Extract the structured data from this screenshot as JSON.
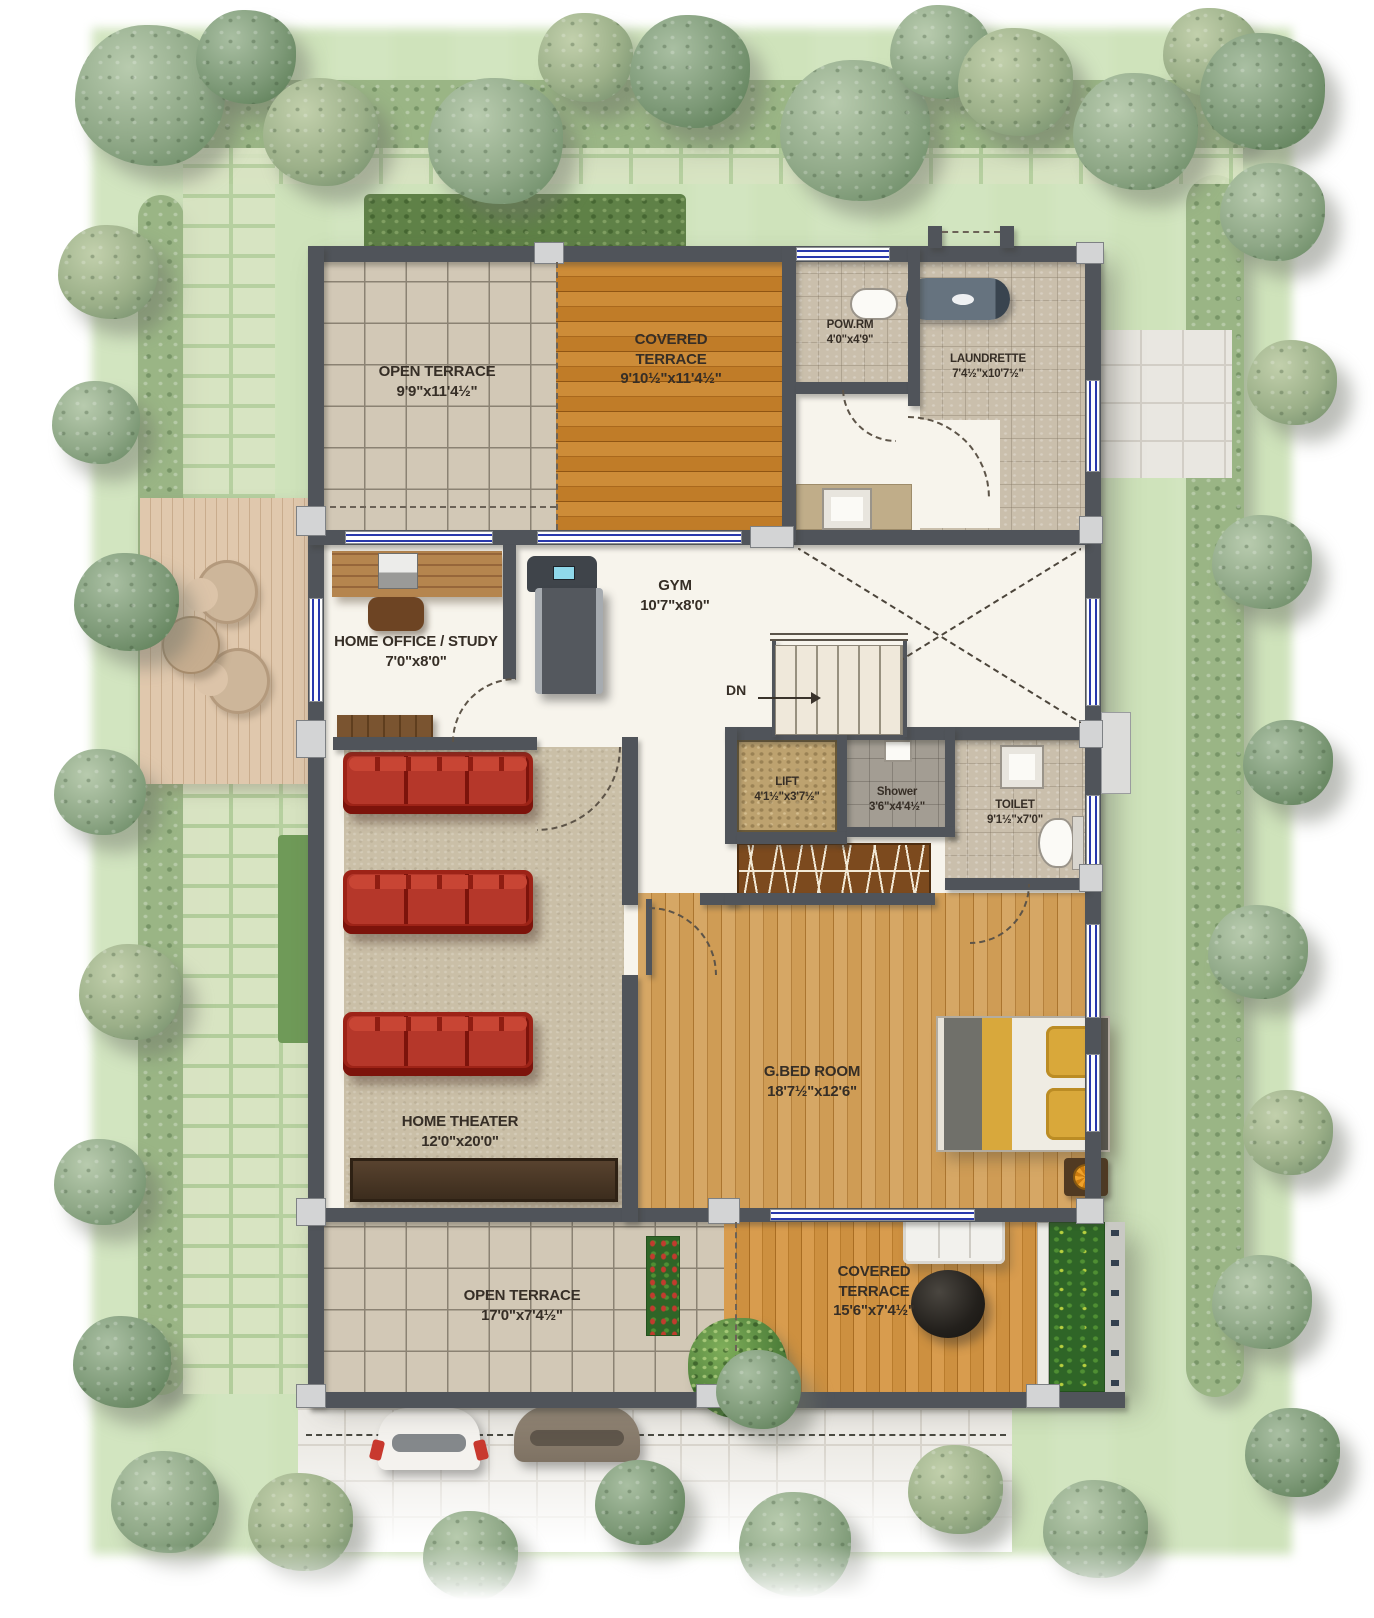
{
  "plan": {
    "type": "architectural-floor-plan",
    "rooms": [
      {
        "id": "open-terrace-top",
        "name": "OPEN TERRACE",
        "dim": "9'9\"x11'4½\""
      },
      {
        "id": "covered-terrace-top",
        "name": "COVERED TERRACE",
        "dim": "9'10½\"x11'4½\""
      },
      {
        "id": "pow-rm",
        "name": "POW.RM",
        "dim": "4'0\"x4'9\""
      },
      {
        "id": "laundrette",
        "name": "LAUNDRETTE",
        "dim": "7'4½\"x10'7½\""
      },
      {
        "id": "home-office-study",
        "name": "HOME OFFICE / STUDY",
        "dim": "7'0\"x8'0\""
      },
      {
        "id": "gym",
        "name": "GYM",
        "dim": "10'7\"x8'0\""
      },
      {
        "id": "lift",
        "name": "LIFT",
        "dim": "4'1½\"x3'7½\""
      },
      {
        "id": "shower",
        "name": "Shower",
        "dim": "3'6\"x4'4½\""
      },
      {
        "id": "toilet",
        "name": "TOILET",
        "dim": "9'1½\"x7'0\""
      },
      {
        "id": "home-theater",
        "name": "HOME THEATER",
        "dim": "12'0\"x20'0\""
      },
      {
        "id": "g-bed-room",
        "name": "G.BED ROOM",
        "dim": "18'7½\"x12'6\""
      },
      {
        "id": "open-terrace-bottom",
        "name": "OPEN TERRACE",
        "dim": "17'0\"x7'4½\""
      },
      {
        "id": "covered-terrace-bottom",
        "name": "COVERED TERRACE",
        "dim": "15'6\"x7'4½\""
      }
    ],
    "stairs": {
      "label": "DN"
    }
  },
  "colors": {
    "wall": "#50545a",
    "window_blue": "#2838ac",
    "label_text": "#362e26",
    "lawn": "#cfe3bb",
    "wood_terrace": "#c2802f",
    "wood_bedroom": "#d0a05f",
    "tile": "#d2c8b6",
    "carpet": "#cabfa7",
    "sofa_red": "#a3271c",
    "bed_yellow": "#d8a83c"
  }
}
